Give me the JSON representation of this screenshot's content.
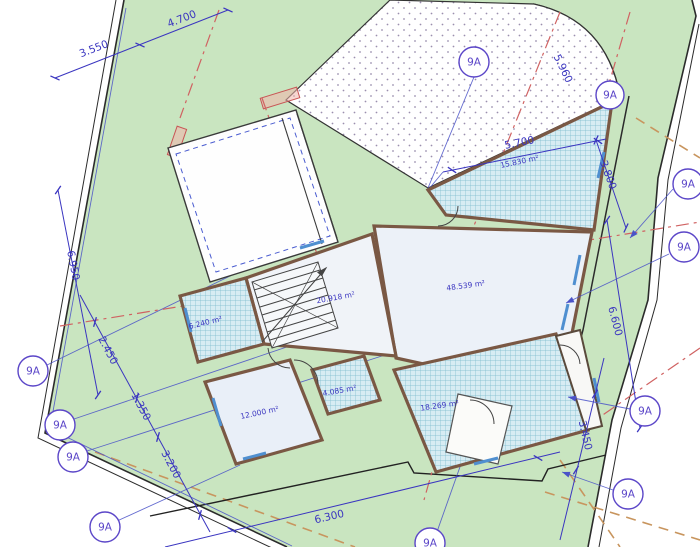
{
  "drawing": {
    "marker_label": "9A",
    "dimensions": {
      "d3550": "3.550",
      "d4700": "4.700",
      "d5960": "5.960",
      "d5700": "5.700",
      "d3800": "3.800",
      "d6600": "6.600",
      "d3450": "3.450",
      "d6300": "6.300",
      "d2450": "2.450",
      "d1350": "1.350",
      "d3200": "3.200",
      "d6950": "6.950"
    },
    "areas": {
      "a6240": "6.240 m²",
      "a20918": "20.918 m²",
      "a48539": "48.539 m²",
      "a15830": "15.830 m²",
      "a12000": "12.000 m²",
      "a4085": "4.085 m²",
      "a18269": "18.269 m²"
    },
    "colors": {
      "site_green": "#c9e5c0",
      "dim_blue": "#3a35c0",
      "marker_purple": "#5b46c8",
      "construct_blue": "#4a52c8",
      "red_dash": "#d06262",
      "tan_dash": "#c8955e",
      "wall_brown": "#7a5844",
      "hatch_teal": "#79bacc",
      "hatch_bg": "#d7ecf3",
      "stipple_gray": "#9b8fae",
      "room_fill": "#ecf1f8"
    }
  }
}
